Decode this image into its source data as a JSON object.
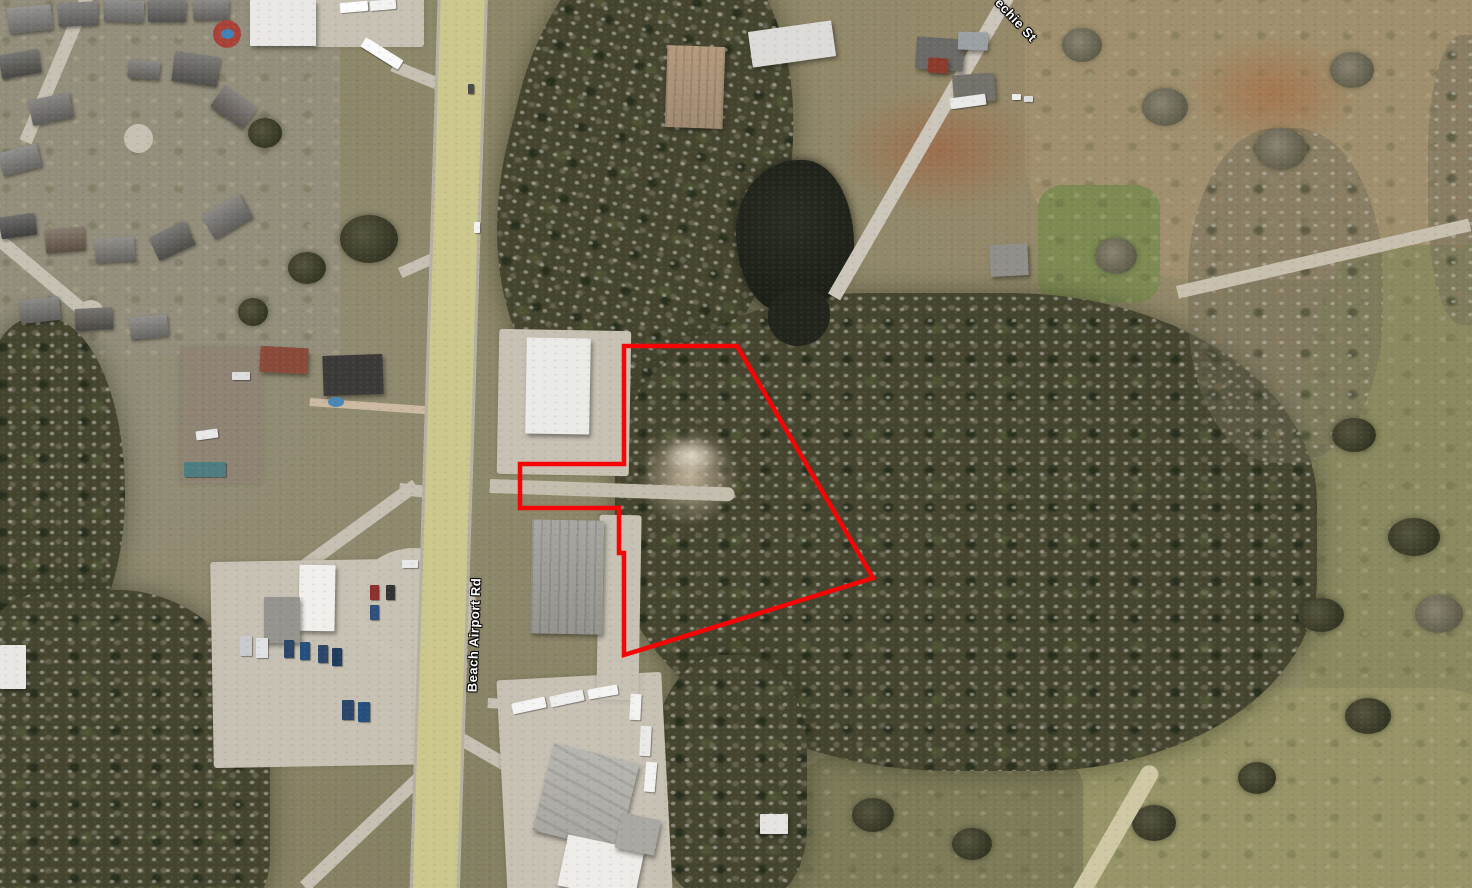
{
  "map": {
    "kind": "satellite-imagery",
    "labels": {
      "beach_airport_rd": "Beach Airport Rd",
      "echie_st": "echie St"
    },
    "parcel": {
      "stroke_color": "#f50505",
      "stroke_width": 4.5,
      "points": "624,346 737,346 873,578 624,655 624,553 619,553 619,508 520,508 520,464 624,464"
    },
    "colors": {
      "parcel_outline": "#f50505",
      "highway_overlay": "#ccc78c"
    }
  }
}
